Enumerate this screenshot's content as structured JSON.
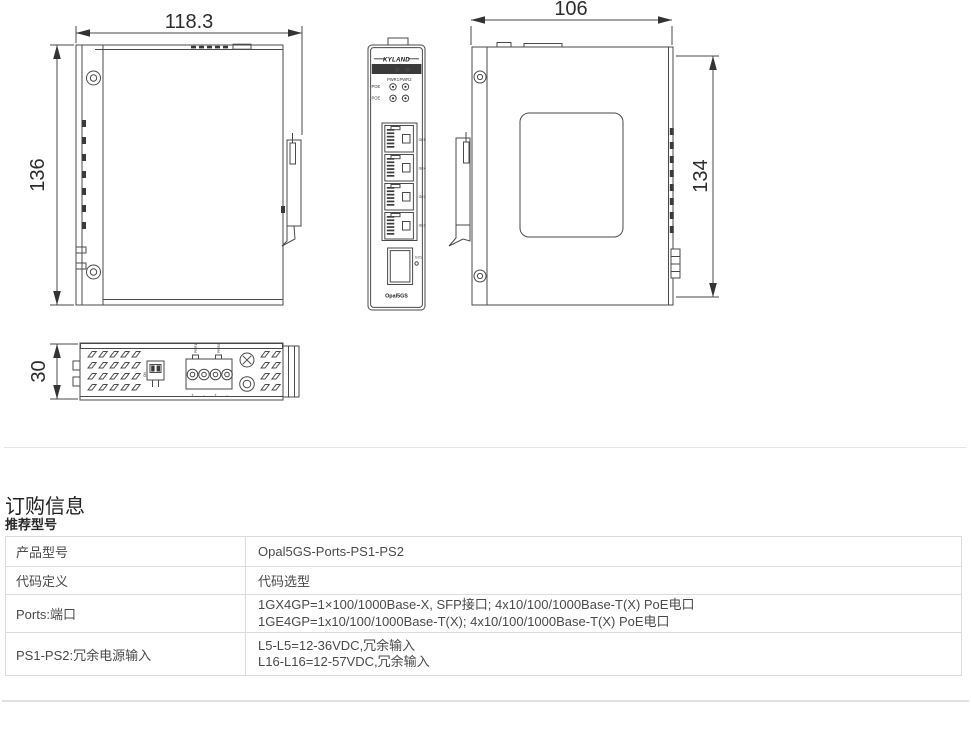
{
  "page": {
    "section_title": "订购信息",
    "subsection_title": "推荐型号"
  },
  "drawings": {
    "left_view": {
      "width_dim": "118.3",
      "height_dim": "136"
    },
    "front_view": {
      "brand": "KYLAND",
      "led_pwr1": "PWR1",
      "led_pwr2": "PWR2",
      "led_poe1": "POE",
      "led_poe2": "POE",
      "port_labels": [
        "GE5",
        "GE4",
        "GE3",
        "GE2"
      ],
      "sfp_label": "GX1",
      "model_label": "Opal5GS"
    },
    "side_view": {
      "width_dim": "106",
      "height_dim": "134"
    },
    "bottom_view": {
      "height_dim": "30",
      "dip_label": "ON",
      "terminal_top_labels": [
        "PWR1",
        "PWR2"
      ],
      "terminal_pin_labels": [
        "+",
        "-",
        "+",
        "-"
      ]
    }
  },
  "order_table": {
    "rows": [
      {
        "label": "产品型号",
        "values": [
          "Opal5GS-Ports-PS1-PS2"
        ]
      },
      {
        "label": "代码定义",
        "values": [
          "代码选型"
        ]
      },
      {
        "label": "Ports:端口",
        "values": [
          "1GX4GP=1×100/1000Base-X, SFP接口; 4x10/100/1000Base-T(X) PoE电口",
          "1GE4GP=1x10/100/1000Base-T(X); 4x10/100/1000Base-T(X) PoE电口"
        ]
      },
      {
        "label": "PS1-PS2:冗余电源输入",
        "values": [
          "L5-L5=12-36VDC,冗余输入",
          "L16-L16=12-57VDC,冗余输入"
        ]
      }
    ]
  }
}
